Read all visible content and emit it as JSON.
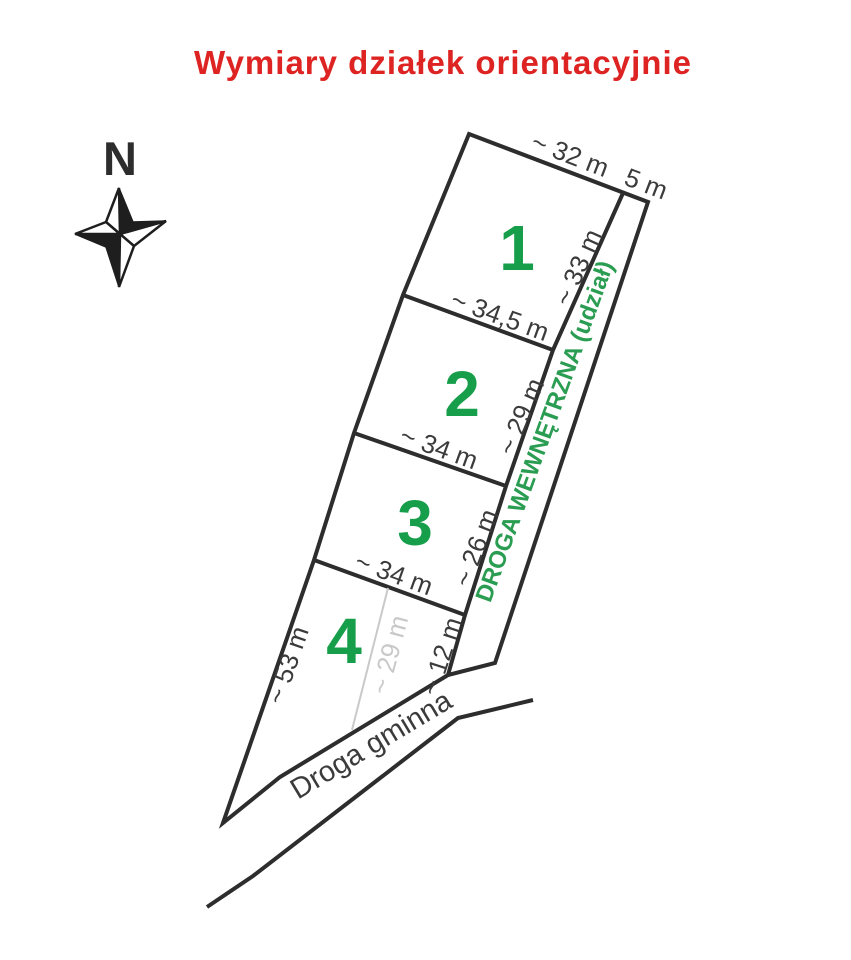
{
  "title": {
    "text": "Wymiary działek orientacyjnie"
  },
  "compass": {
    "north_label": "N"
  },
  "plots": [
    {
      "number": "1",
      "top_dim": "~ 32 m",
      "right_dim": "~ 33 m",
      "bottom_dim": "~ 34,5 m"
    },
    {
      "number": "2",
      "right_dim": "~ 29 m",
      "bottom_dim": "~ 34 m"
    },
    {
      "number": "3",
      "right_dim": "~ 26 m",
      "bottom_dim": "~ 34 m"
    },
    {
      "number": "4",
      "left_dim": "~ 53 m",
      "middle_dim": "~ 29 m",
      "right_dim": "~ 12 m"
    }
  ],
  "roads": {
    "internal_label": "DROGA WEWNĘTRZNA (udział)",
    "internal_width": "5 m",
    "municipal_label": "Droga gminna"
  },
  "colors": {
    "title_red": "#dd2423",
    "plot_number_green": "#169e4b",
    "road_label_green": "#2a9d52",
    "dimension_gray": "#3b3b3b",
    "light_gray": "#c9c9c9",
    "line_dark": "#2d2d2d"
  }
}
